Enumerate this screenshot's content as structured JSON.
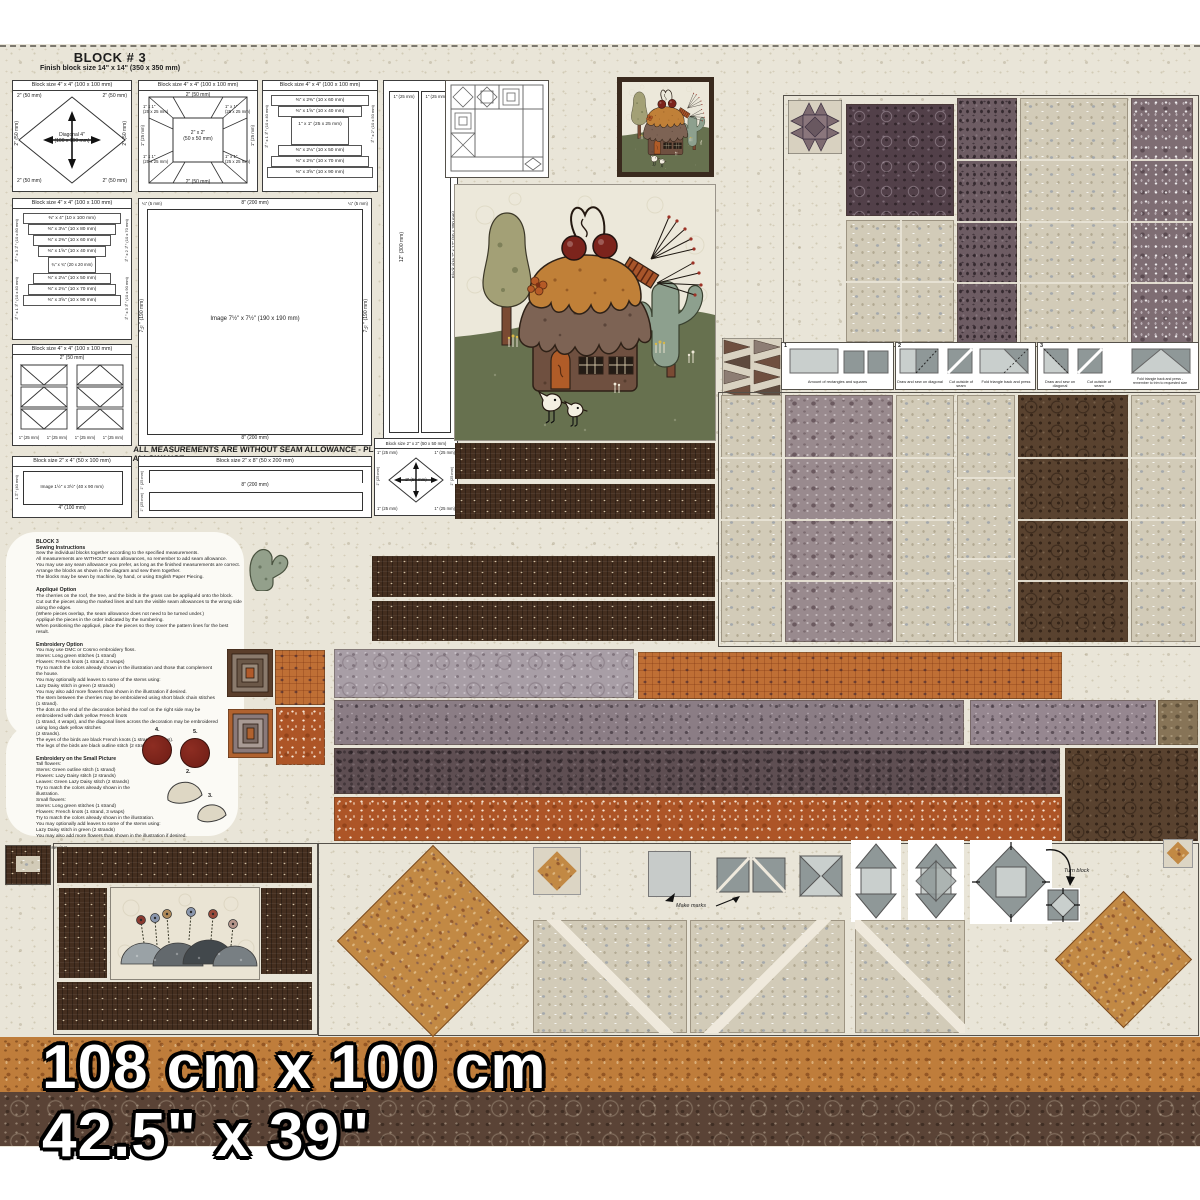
{
  "panel": {
    "title": "BLOCK # 3",
    "subtitle": "Finish block size 14\" x 14\"  (350 x 350 mm)",
    "seam_note": "ALL MEASUREMENTS ARE WITHOUT SEAM ALLOWANCE - PLEASE ADD SEAM ALLOWANCE"
  },
  "sizes": {
    "cm": "108 cm x 100 cm",
    "inches": "42.5\" x 39\""
  },
  "labels": {
    "block4": "Block size 4\" x 4\"   (100 x 100 mm)",
    "block2x4": "Block size 2\" x 4\"   (50 x 100 mm)",
    "block2x8": "Block size 2\" x 8\"   (50 x 200 mm)",
    "block2x2": "Block size 2\" x 2\"  (50 x 50 mm)",
    "block2x12": "Block size 2\" x 12\"  (50 x 300 mm)",
    "image_main": "Image  7½\" x 7½\"  (190 x 190 mm)",
    "image_small": "Image  1½\" x 3½\"  (40 x 90 mm)",
    "diagonal": "Diagonal 4\"\n(100 x 100 mm)",
    "d2": "2\" (50 mm)",
    "d1": "1\" (25 mm)",
    "d1x1": "1\" x 1\"\n(25 x 25 mm)",
    "d2x2": "2\" x 2\"\n(50 x 50 mm)",
    "d8": "8\" (200 mm)",
    "d12": "12\" (300 mm)",
    "d4": "4\" (100 mm)",
    "d40": "1½\" (40 mm)",
    "d7h": "7½\" (190 mm)",
    "dq": "¼\" (5 mm)",
    "lc": [
      "⅜\" x 4\"  (10 x 100 mm)",
      "⅜\" x 3⅛\"  (10 x 80 mm)",
      "⅜\" x 2⅜\"  (10 x 60 mm)",
      "⅜\" x 1⅝\"  (10 x 40 mm)",
      "¾\" x ¾\"  (20 x 20 mm)",
      "⅜\" x 2⅛\"  (10 x 50 mm)",
      "⅜\" x 2¾\"  (10 x 70 mm)",
      "⅜\" x 3⅝\"  (10 x 90 mm)"
    ],
    "lcl": [
      "⅜\" x 3⅛\" (10 x 80 mm)",
      "⅜\" x 2⅜\" (10 x 60 mm)",
      "⅜\" x 1⅝\" (10 x 40 mm)"
    ],
    "lcr": [
      "⅜\" x 2\" (10 x 50 mm)",
      "⅜\" x 2¾\" (10 x 70 mm)",
      "⅜\" x 3⅝\" (10 x 90 mm)"
    ]
  },
  "instructions": [
    {
      "heading": "BLOCK 3\nSewing Instructions",
      "body": "Sew the individual blocks together according to the specified measurements.\nAll measurements are WITHOUT seam allowances, so remember to add seam allowance.\nYou may use any seam allowance you prefer, as long as the finished measurements are correct.\nArrange the blocks as shown in the diagram and sew them together.\nThe blocks may be sewn by machine, by hand, or using English Paper Piecing."
    },
    {
      "heading": "Appliqué Option",
      "body": "The cherries on the roof, the tree, and the birds in the grass can be appliquéd onto the block.\nCut out the pieces along the marked lines and turn the visible seam allowances to the wrong side along the edges.\n(Where pieces overlap, the seam allowance does not need to be turned under.)\nAppliqué the pieces in the order indicated by the numbering.\nWhen positioning the appliqué, place the pieces so they cover the pattern lines for the best result."
    },
    {
      "heading": "Embroidery Option",
      "body": "You may use DMC or Cosmo embroidery floss.\nStems: Long green stitches (1 strand)\nFlowers: French knots (1 strand, 3 wraps)\nTry to match the colors already shown in the illustration and those that complement\nthe house.\nYou may optionally add leaves to some of the stems using:\nLazy Daisy stitch in green (2 strands)\nYou may also add more flowers than shown in the illustration if desired.\nThe stem between the cherries may be embroidered using short black chain stitches\n(1 strand).\nThe dots at the end of the decoration behind the roof on the right side may be\nembroidered with dark yellow French knots\n(1 strand, 4 wraps), and the diagonal lines across the decoration may be embroidered\nusing long dark yellow stitches\n(2 strands).\nThe eyes of the birds are black French knots (1 strand, 2 wraps).\nThe legs of the birds are black outline stitch (2 strands)."
    },
    {
      "heading": "Embroidery on the Small Picture",
      "body": "Tall flowers:\nStems: Green outline stitch (1 strand)\nFlowers: Lazy Daisy stitch (2 strands)\nLeaves: Green Lazy Daisy stitch (2 strands)\nTry to match the colors already shown in the\nillustration.\nSmall flowers:\nStems: Long green stitches (1 strand)\nFlowers: French knots (1 strand, 3 wraps)\nTry to match the colors already shown in the illustration.\nYou may optionally add leaves to some of the stems using:\nLazy Daisy stitch in green (2 strands)\nYou may also add more flowers than shown in the illustration if desired."
    },
    {
      "heading": "",
      "body": "Happy sewing!"
    }
  ],
  "geese": {
    "n1": "1",
    "n2": "2",
    "n3": "3",
    "c1": "Amount of rectangles and squares",
    "c2a": "Draw and sew on diagonal",
    "c2b": "Cut outside of seam",
    "c2c": "Fold triangle back and press",
    "c3a": "Draw and sew on diagonal",
    "c3b": "Cut outside of seam",
    "c3c": "Fold triangle back and press -\nremember to trim to requested size"
  },
  "guide": {
    "make_marks": "Make marks",
    "turn_block": "Turn block"
  },
  "applique": {
    "n2": "2.",
    "n3": "3.",
    "n4": "4.",
    "n5": "5."
  },
  "colors": {
    "cream": "#e9e5d8",
    "dark_brown": "#442e1f",
    "plum": "#524049",
    "mauve": "#998a8e",
    "beige": "#d2cbb8",
    "rust": "#ad5527",
    "caramel": "#bf7d3b",
    "orange_block": "#c28944",
    "grass_green": "#67714f",
    "sage": "#93a08b",
    "cherry_red": "#7c241c",
    "brown_rings": "#59422f",
    "lavender": "#a89ea6"
  }
}
